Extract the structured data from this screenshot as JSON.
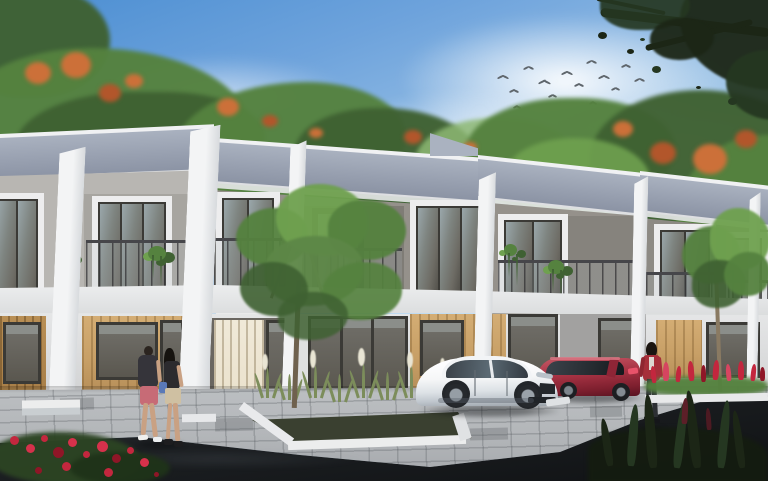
{
  "meta": {
    "title": "Modern townhouse development - exterior architectural rendering",
    "image_type": "3D architectural visualization, no on-screen text",
    "view": "street-level perspective of a row of two-storey townhouses receding to the right"
  },
  "scene": {
    "sky": "blue sky, brightest deep blue at upper left, soft white clouds on the right half",
    "birds": "flock of about 14 small birds flying above the centre rooftops",
    "background_vegetation": "dense green trees behind the houses dotted with orange blossoms; a dark leafy tree branch overhangs the top-right corner",
    "buildings": "six attached two-storey townhouse units with grey mono-pitch roofs, tall white party-wall fins between units, taupe-grey upper facades, white-framed projecting window boxes with dark glazing, glass-and-steel balcony railings with trailing vines, a white floor slab band, and ground floors mixing light timber cladding, cream vertical blinds and full-height dark-framed glazing",
    "landscaping": "grey paver walkway along the houses, white-edged planter with ornamental grasses, white plumes and a young tree in the centre, red rose bush in the near-left corner, red celosia flower bed on the right, dark spiky shrubs in the near-right corner, small tree in front of the right units",
    "vehicles": "white fastback sedan parked facing right; dark-red hatchback parked behind it; white wheel-stop on the paving",
    "people": "man in dark tee and pink shorts walking with woman in dark top and khaki shorts on the left; woman in red blazer and dark trousers walking on the right",
    "road": "dark asphalt street across the bottom foreground"
  },
  "counts": {
    "townhouse_units": 6,
    "birds": 14,
    "cars": 2,
    "people": 3
  },
  "colors": {
    "sky-top": "#4b8ed2",
    "sky-mid": "#a3c8e8",
    "sky-low": "#dcedf9",
    "bird": "#5f666c",
    "tree-dark": "#3f6132",
    "tree-mid": "#55823f",
    "tree-light": "#6fa14f",
    "tree-pale": "#8db873",
    "blossom": "#cc7039",
    "blossom-deep": "#b2562b",
    "branch-dark": "#1c2616",
    "branch-leaf": "#253721",
    "roof-light": "#aab2c0",
    "roof-mid": "#98a0b0",
    "roof-dark": "#8a92a3",
    "fascia": "#f0f1f3",
    "fin-white": "#f3f4f5",
    "fin-shade": "#d7dadd",
    "facade-light": "#b8b6b2",
    "facade-taupe": "#95918b",
    "facade-dark": "#7f7c76",
    "frame-white": "#ededee",
    "win-frame": "#3b3a36",
    "glass-dark": "#6d6b64",
    "glass-light": "#9aa7ab",
    "band-white": "#eff0f1",
    "wood": "#c79f66",
    "wood-dark": "#a87f48",
    "blinds": "#e9e0ca",
    "ground-white": "#e5e6e7",
    "wall-gray": "#a2a1a0",
    "paver": "#b3b6b9",
    "paver-joint": "rgba(70,75,80,0.25)",
    "road-top": "#2e3236",
    "road-bottom": "#101214",
    "car-white": "#f5f6f7",
    "car-glass": "#323940",
    "car-red": "#a73344",
    "car-red-dark": "#6b1826",
    "flower-red": "#c3273e",
    "flower-deep": "#8f1627",
    "leaf-dark": "#2c4423",
    "grass-green": "#7c8d5b",
    "plume": "#e9e5d4",
    "soil": "#3a4030",
    "skin": "#c9a183",
    "jacket-red": "#a62f3a",
    "shorts-pink": "#c76b76",
    "shorts-khaki": "#cfc0a2",
    "bag-blue": "#5a79b8",
    "trunk": "#6f614e",
    "shadow": "rgba(10,12,14,0.42)"
  }
}
